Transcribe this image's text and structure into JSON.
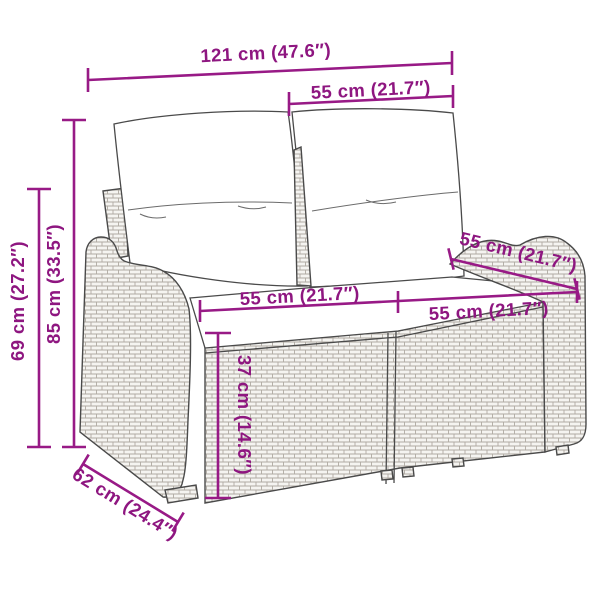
{
  "diagram": {
    "title": "Garden bench dimension diagram",
    "subject": "poly rattan 2-seater garden bench with back and seat cushions",
    "accent_color": "#981A86",
    "outline_color": "#4a4a4a",
    "dimensions": {
      "total_width": "121 cm (47.6″)",
      "back_cushion_width": "55 cm (21.7″)",
      "total_height": "85 cm (33.5″)",
      "armrest_height": "69 cm (27.2″)",
      "depth": "62 cm (24.4″)",
      "seat_width_left": "55 cm (21.7″)",
      "seat_width_right": "55 cm (21.7″)",
      "seat_depth_right": "55 cm (21.7″)",
      "seat_height": "37 cm (14.6″)"
    }
  }
}
